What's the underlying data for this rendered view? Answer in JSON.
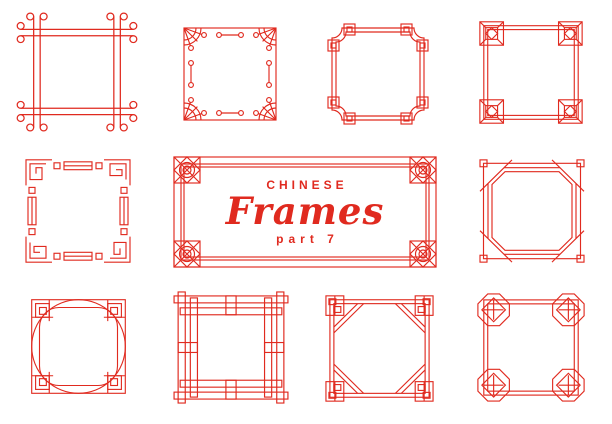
{
  "canvas": {
    "width": 612,
    "height": 424,
    "background": "#ffffff",
    "line_color": "#e02a1f"
  },
  "banner": {
    "eyebrow": "CHINESE",
    "title": "Frames",
    "subtitle": "part 7"
  },
  "frames": [
    {
      "name": "knot-loop-corners-frame",
      "position": "row1-col1"
    },
    {
      "name": "bead-circles-fan-corners-frame",
      "position": "row1-col2"
    },
    {
      "name": "scooped-corners-nested-squares-frame",
      "position": "row1-col3"
    },
    {
      "name": "corner-blocks-diamond-frame",
      "position": "row1-col4"
    },
    {
      "name": "greek-key-meander-frame",
      "position": "row2-col1"
    },
    {
      "name": "banner-ornate-corner-frame",
      "position": "row2-center"
    },
    {
      "name": "chamfered-double-line-frame",
      "position": "row2-col4"
    },
    {
      "name": "circle-rounded-square-frame",
      "position": "row3-col1"
    },
    {
      "name": "interlocking-strips-frame",
      "position": "row3-col2"
    },
    {
      "name": "octagon-inset-key-corners-frame",
      "position": "row3-col3"
    },
    {
      "name": "octagon-medallion-corners-frame",
      "position": "row3-col4"
    }
  ]
}
